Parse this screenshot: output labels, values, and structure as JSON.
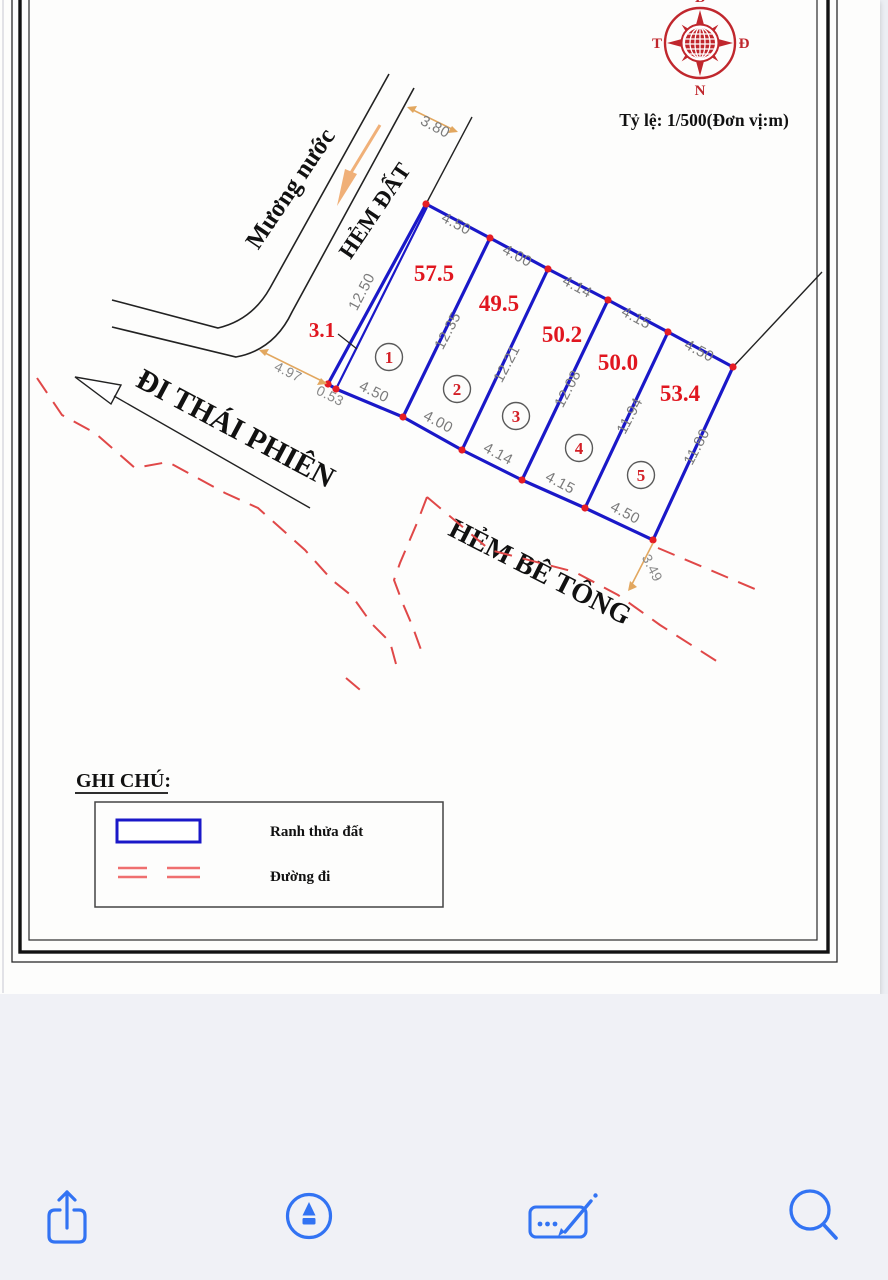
{
  "scale_note": "Tỷ lệ: 1/500(Đơn vị:m)",
  "compass": {
    "top": "B",
    "left": "T",
    "right": "Đ",
    "bottom": "N"
  },
  "labels": {
    "water_channel": "Mương nước",
    "dirt_alley": "HẺM ĐẤT",
    "thai_phien": "ĐI THÁI PHIÊN",
    "concrete_alley": "HẺM BÊ TÔNG"
  },
  "parcels": [
    {
      "no": "1",
      "area": "57.5"
    },
    {
      "no": "2",
      "area": "49.5"
    },
    {
      "no": "3",
      "area": "50.2"
    },
    {
      "no": "4",
      "area": "50.0"
    },
    {
      "no": "5",
      "area": "53.4"
    }
  ],
  "dims": {
    "top": [
      "4.50",
      "4.00",
      "4.14",
      "4.15",
      "4.50"
    ],
    "sides": [
      "12.50",
      "12.35",
      "12.21",
      "12.08",
      "11.94",
      "11.80"
    ],
    "bottom": [
      "4.50",
      "4.00",
      "4.14",
      "4.15",
      "4.50"
    ],
    "alley_width": "3.80",
    "front_a": "4.97",
    "front_b": "0.53",
    "rear_width": "3.49",
    "sliver_area": "3.1"
  },
  "legend": {
    "title": "GHI CHÚ:",
    "boundary_label": "Ranh thửa đất",
    "road_label": "Đường đi"
  },
  "toolbar": {
    "items": [
      "share",
      "markup",
      "fill-sign",
      "search"
    ]
  },
  "colors": {
    "parcel_boundary": "#1a18c8",
    "area_text": "#e0161f",
    "vertex_dot": "#e51d24",
    "dim_text": "#7b7b7b",
    "dashed_road": "#e04848",
    "compass": "#c0272d",
    "dim_line": "#e2a75f",
    "toolbar_icon": "#3273f3",
    "toolbar_bg": "#f0f1f6"
  }
}
